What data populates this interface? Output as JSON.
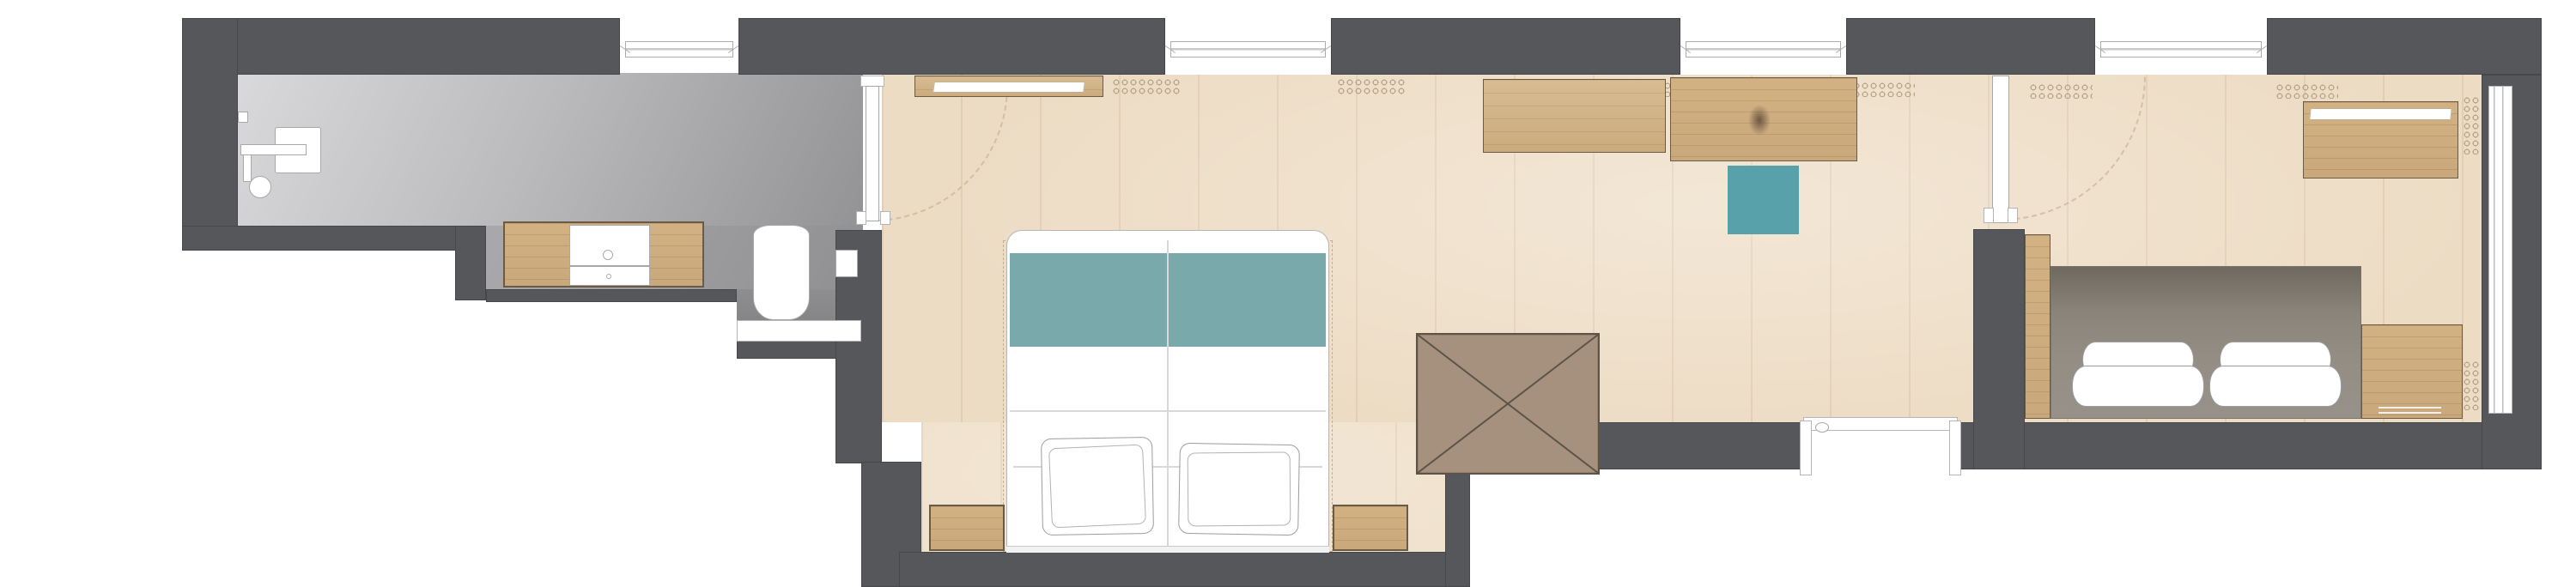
{
  "title": "Hotel suite floor plan",
  "colors": {
    "wall": "#56575a",
    "bath_floor_light": "#d9d9db",
    "bath_floor_dark": "#939395",
    "wood_floor": "#eddcc4",
    "wood_furniture": "#c9a87b",
    "wood_furniture_dark": "#6b5a44",
    "bed_runner_teal": "#7aa9ab",
    "stool_teal": "#58a1ab",
    "sofa_taupe": "#938d83",
    "luggage_rack_brown": "#a5917d",
    "fixture_outline": "#a8a8aa",
    "door_swing_tan": "#c8b496",
    "radiator_glyph": "#b09b80"
  },
  "elements": {
    "rooms": [
      "bathroom",
      "bedroom",
      "living-area",
      "second-bedroom"
    ],
    "bathroom_fixtures": [
      "shower",
      "shower-head",
      "vanity-cabinet",
      "sink",
      "toilet",
      "flush-plate"
    ],
    "bedroom_furniture": [
      "wall-shelf",
      "double-bed",
      "teal-bed-runner",
      "pillow-left",
      "pillow-right",
      "nightstand-left",
      "nightstand-right"
    ],
    "living_furniture": [
      "sideboard",
      "desk",
      "teal-stool",
      "luggage-rack"
    ],
    "second_bedroom_furniture": [
      "wardrobe",
      "sofa-bed",
      "folded-duvet-left",
      "folded-duvet-right",
      "side-cabinet"
    ],
    "openings": [
      "bathroom-door",
      "connecting-door",
      "entrance-door",
      "window-bathroom",
      "window-bedroom",
      "window-living",
      "window-second-bedroom",
      "window-right-wall"
    ],
    "radiator_count": 8
  }
}
